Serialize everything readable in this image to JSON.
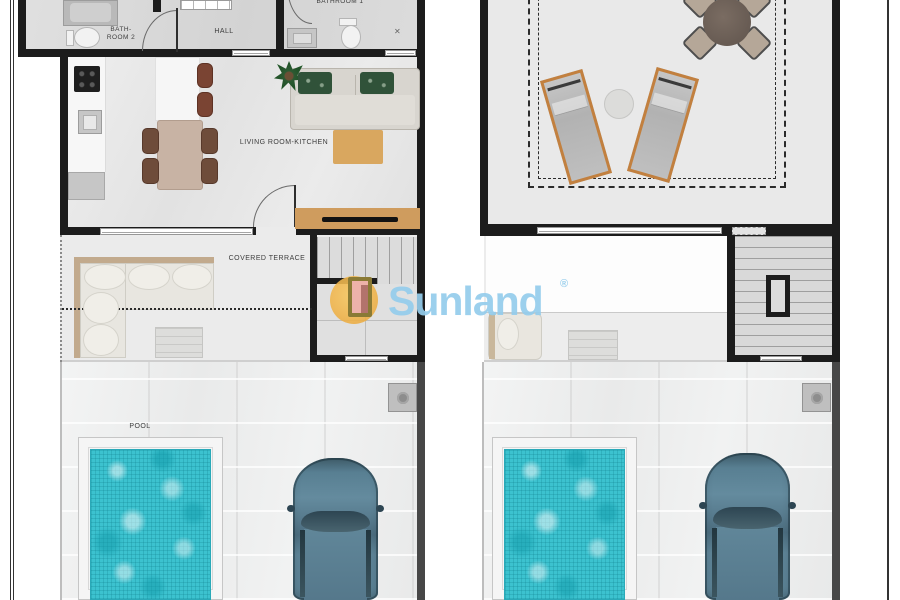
{
  "page": {
    "kind": "floor-plan-sheet",
    "background": "#ffffff"
  },
  "watermark": {
    "brand": "Sunland",
    "registered_mark": "®",
    "colors": {
      "text": "#94cceb",
      "sun": "#f0b44a",
      "door_fill": "#edb2aa",
      "door_frame": "#8a7a35"
    }
  },
  "ground_floor": {
    "labels": {
      "bathroom2_line1": "BATH-",
      "bathroom2_line2": "ROOM 2",
      "hall": "HALL",
      "bathroom1": "BATHROOM 1",
      "living_kitchen": "LIVING ROOM-KITCHEN",
      "covered_terrace": "COVERED TERRACE",
      "pool": "POOL"
    },
    "fixtures": [
      "shower",
      "toilet",
      "washbasin",
      "kitchen-counter",
      "hob",
      "kitchen-sink",
      "fridge",
      "island",
      "bar-stools",
      "dining-table",
      "dining-chairs",
      "sofa",
      "green-cushions",
      "rug",
      "tv-unit",
      "plant",
      "outdoor-corner-sofa",
      "coffee-table",
      "staircase",
      "pool",
      "car",
      "ac-unit"
    ]
  },
  "solarium_floor": {
    "fixtures": [
      "round-dining-table",
      "four-chairs",
      "sun-lounger-left",
      "sun-lounger-right",
      "side-table-round",
      "safety-rail-dashed-line",
      "lounge-chair",
      "slatted-table",
      "staircase",
      "stair-void",
      "pool",
      "car",
      "ac-unit"
    ]
  },
  "colors": {
    "wall": "#1c1c1c",
    "pool_water": "#3cc2cf",
    "pool_deck": "#f5f5f5",
    "car_body": "#5d8396",
    "dining_table": "#c8b3a4",
    "chair_brown": "#6e4c3a",
    "rug": "#d9a75f",
    "tv_unit_wood": "#cf9c5e",
    "sofa_gray": "#d8d5cf",
    "cushion_green": "#305239",
    "lounger_frame": "#c2803f",
    "outdoor_tile": "#eff0f0"
  }
}
